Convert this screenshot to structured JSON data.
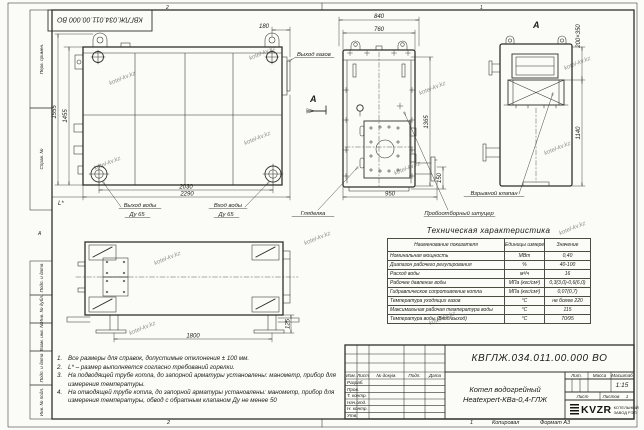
{
  "watermark": "kotel-kv.kz",
  "frame": {
    "zone_top_left": "2",
    "zone_top_right": "1",
    "zone_bottom_left": "2",
    "zone_bottom_right": "1",
    "fold_mark": "А"
  },
  "stamp_top": {
    "doc_number": "КВГЛЖ.034.011.00.000 ВО"
  },
  "margin": {
    "labels": [
      "Перв. примен.",
      "Справ. №",
      "Подп. и дата",
      "Инв. № дубл.",
      "Взам. инв. №",
      "Подп. и дата",
      "Инв. № подл."
    ]
  },
  "views": {
    "side": {
      "dim_1555": "1555",
      "dim_1455": "1455",
      "dim_180": "180",
      "dim_2030": "2030",
      "dim_2290": "2290",
      "dim_L": "L*",
      "label_gas_out": "Выход газов",
      "label_water_out_1": "Выход воды",
      "label_water_out_2": "Ду 65",
      "label_water_in_1": "Вход воды",
      "label_water_in_2": "Ду 65",
      "view_arrow_letter": "А"
    },
    "front": {
      "dim_840": "840",
      "dim_760": "760",
      "dim_1365": "1365",
      "dim_950": "950",
      "dim_150": "150",
      "label_sight_glass": "Гляделка",
      "label_sampling": "Пробоотборный штуцер"
    },
    "rear": {
      "view_title": "А",
      "dim_valve": "200×350",
      "dim_1140": "1140",
      "label_explosion_valve": "Взрывной клапан"
    },
    "top": {
      "dim_1800": "1800",
      "dim_125": "125"
    }
  },
  "table": {
    "title": "Техническая характеристика",
    "headers": [
      "Наименование показателя",
      "Единицы измерения",
      "Значение"
    ],
    "rows": [
      [
        "Номинальная мощность",
        "МВт",
        "0,40"
      ],
      [
        "Диапазон рабочего регулирования",
        "%",
        "40-100"
      ],
      [
        "Расход воды",
        "м³/ч",
        "16"
      ],
      [
        "Рабочее давление воды",
        "МПа (кгс/см²)",
        "0,3(3,0)-0,6(6,0)"
      ],
      [
        "Гидравлическое сопротивление котла",
        "МПа (кгс/см²)",
        "0,07(0,7)"
      ],
      [
        "Температура уходящих газов",
        "°С",
        "не более 220"
      ],
      [
        "Максимальная рабочая температура воды",
        "°С",
        "115"
      ],
      [
        "Температура воды (Вход/выход)",
        "°С",
        "70/95"
      ]
    ]
  },
  "notes": [
    {
      "num": "1.",
      "text": "Все размеры для справок, допустимые отклонения ± 100 мм."
    },
    {
      "num": "2.",
      "text": "L* – размер выполняется согласно требований горелки."
    },
    {
      "num": "3.",
      "text": "На подводящей трубе котла, до запорной арматуры установлены: манометр, прибор для измерения температуры."
    },
    {
      "num": "4.",
      "text": "На отводящей трубе котла, до запорной арматуры установлены: манометр, прибор для измерения температуры, обвод с обратным клапаном Ду не менее 50"
    }
  ],
  "title_block": {
    "doc_number": "КВГЛЖ.034.011.00.000 ВО",
    "product_line1": "Котел водогрейный",
    "product_line2": "Heatexpert-КВа-0,4-ГЛЖ",
    "lit_label": "Лит.",
    "mass_label": "Масса",
    "scale_label": "Масштаб",
    "scale_value": "1:15",
    "sheet_label": "Лист",
    "sheets_label": "Листов",
    "sheets_value": "1",
    "header_cells": [
      "Изм.",
      "Лист",
      "№ докум.",
      "Подп.",
      "Дата"
    ],
    "sign_rows": [
      "Разраб.",
      "Пров.",
      "Т. контр.",
      "Нач.отд.",
      "Н. контр.",
      "Утв."
    ],
    "company": "KVZR",
    "company_desc1": "КОТЕЛЬНЫЙ",
    "company_desc2": "ЗАВОД РЭП",
    "copied": "Копировал",
    "format": "Формат А3"
  }
}
